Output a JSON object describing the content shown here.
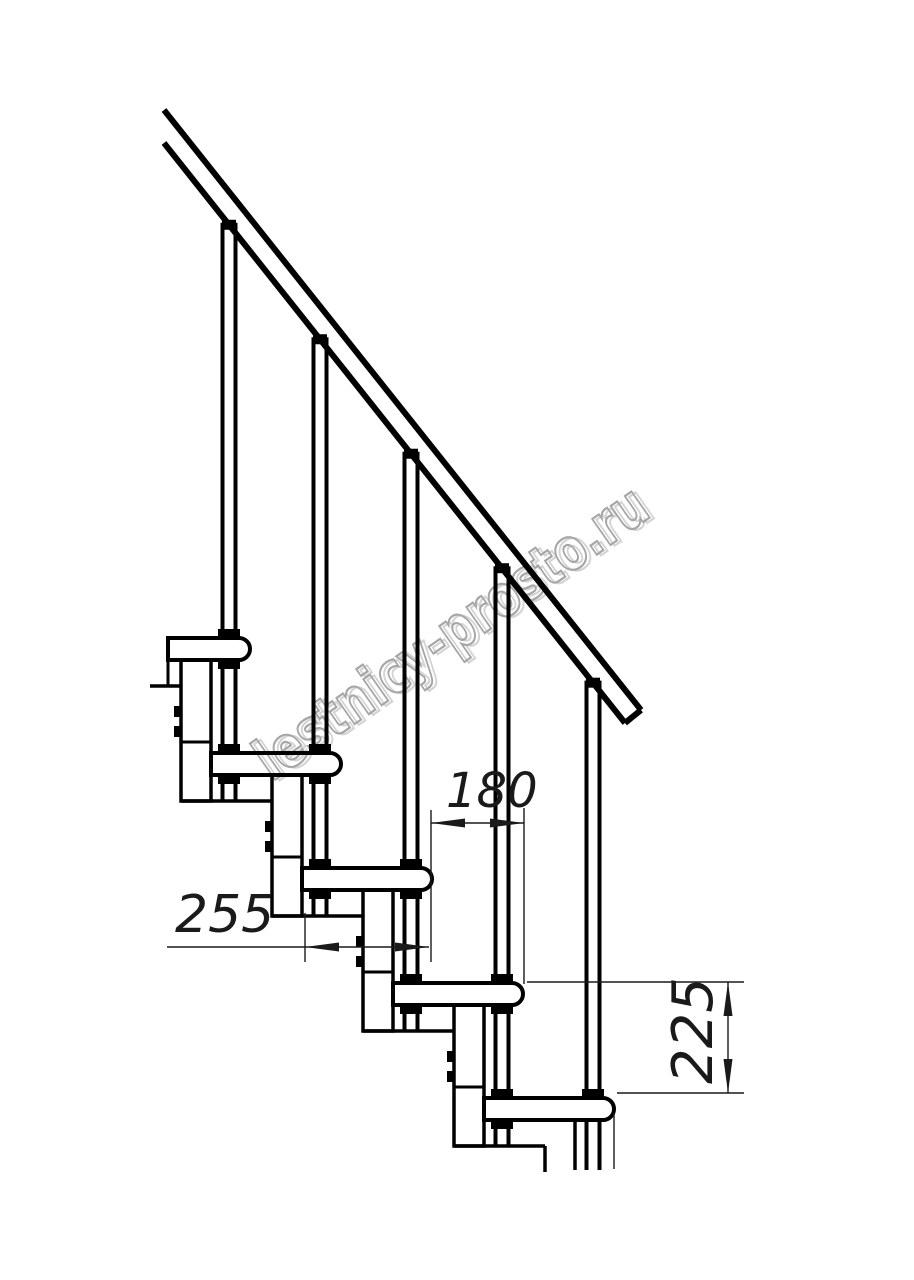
{
  "document": {
    "type": "technical-drawing",
    "subject": "modular staircase side view with step dimensions"
  },
  "watermark": {
    "text": "lestnicy-prosto.ru",
    "stroke_color": "#a6a6a6",
    "shadow_color": "#d4d4d4",
    "angle_deg": -35,
    "font_size": 58,
    "text_length": 465,
    "x": 272,
    "y": 782
  },
  "annotations": {
    "dim_step_run": "180",
    "dim_tread_depth": "255",
    "dim_step_rise": "225"
  },
  "style": {
    "line_color": "#000000",
    "thin_line_color": "#1a1a1a",
    "background": "#ffffff"
  },
  "geometry": {
    "canvas": {
      "w": 914,
      "h": 1280
    },
    "steps": {
      "count": 5,
      "first_tread_top": 638,
      "rise": 115,
      "first_nose_right": 250,
      "run": 91,
      "tread_height": 22,
      "tread_length": 130,
      "first_tread_left": 168,
      "nose_radius": 11,
      "tread_stroke": 4
    },
    "baluster": {
      "offset_from_nose": 21,
      "half_gap": 6.5,
      "stroke": 4,
      "cap_w": 14,
      "cap_h": 10,
      "flange_w": 22,
      "flange_h": 9
    },
    "rail": {
      "top": [
        164,
        110,
        641,
        710
      ],
      "bottom": [
        164,
        143,
        625,
        723
      ],
      "cut": [
        641,
        710,
        625,
        723
      ],
      "stroke": 6,
      "bottom_intercept": 143,
      "bottom_x0": 164,
      "slope": 1.258
    },
    "column": {
      "offset_left_from_nose": 69,
      "width": 30,
      "top_offset": 22,
      "bottom_offset": 163,
      "divider_offset": 104,
      "tab_offsets": [
        68,
        88
      ],
      "tab_w": 7,
      "tab_h": 11,
      "plate_span": 121,
      "stroke": 3.5
    },
    "pre_plate": [
      150,
      686,
      181,
      686
    ],
    "last_module": {
      "left_line": [
        545,
        1146,
        545,
        1172
      ],
      "right_line": [
        575,
        1120,
        575,
        1170
      ],
      "baluster_bottom": 1170
    },
    "dims": {
      "ext_lines": [
        [
          431,
          810,
          431,
          962
        ],
        [
          524,
          808,
          524,
          984
        ],
        [
          305,
          913,
          305,
          962
        ],
        [
          527,
          982,
          744,
          982
        ],
        [
          617,
          1093,
          744,
          1093
        ],
        [
          614,
          1113,
          614,
          1169
        ]
      ],
      "dim_lines": [
        [
          431,
          823,
          524,
          823
        ],
        [
          167,
          947,
          429,
          947
        ],
        [
          728,
          982,
          728,
          1093
        ]
      ],
      "arrows": [
        [
          431,
          823,
          "left"
        ],
        [
          524,
          823,
          "right"
        ],
        [
          305,
          947,
          "left"
        ],
        [
          429,
          947,
          "right"
        ],
        [
          728,
          982,
          "up"
        ],
        [
          728,
          1093,
          "down"
        ]
      ],
      "labels": [
        {
          "bind": "annotations.dim_step_run",
          "name": "dimension-label-180",
          "x": 446,
          "y": 807,
          "fs": 48,
          "rot": 0
        },
        {
          "bind": "annotations.dim_tread_depth",
          "name": "dimension-label-255",
          "x": 175,
          "y": 932,
          "fs": 52,
          "rot": 0
        },
        {
          "bind": "annotations.dim_step_rise",
          "name": "dimension-label-225",
          "x": 712,
          "y": 1084,
          "fs": 56,
          "rot": -90
        }
      ],
      "arrow_len": 34,
      "arrow_halfwidth": 4.5,
      "thin_stroke": 1.4
    }
  }
}
